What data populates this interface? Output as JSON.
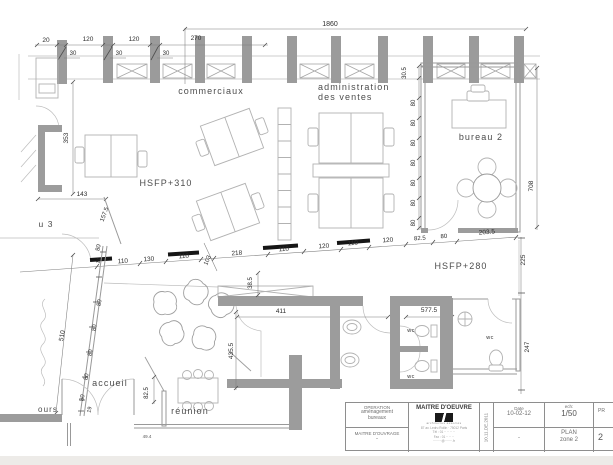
{
  "colors": {
    "wall_gray": "#9c9c9c",
    "line_gray": "#9a9a9a",
    "furniture_gray": "#b2b2b2",
    "beam_black": "#161616",
    "dim_text": "#2d2d2d",
    "paper": "#ffffff",
    "footer_strip": "#edebe8"
  },
  "title_block": {
    "operation_label": "OPERATION",
    "operation_l1": "aménagement",
    "operation_l2": "bureaux",
    "ouvrage_label": "MAITRE  D'OUVRAGE",
    "ouvrage_value": "-",
    "oeuvre_label": "MAITRE D'OEUVRE",
    "oeuvre_caption": "architectes associés",
    "addr1": "87 av. Ledru Rollin · 75012 Paris",
    "addr2": "Tél : 01 ·· ·· ·· ··",
    "addr3": "Fax : 01 ·· ·· ··",
    "addr4": "········@·······.fr",
    "stamp": "10.11.DE.2011",
    "date_label": "Date",
    "date_value": "10-02-12",
    "date_below": "-",
    "scale_label": "ech:",
    "scale_value": "1/50",
    "plan_l1": "PLAN",
    "plan_l2": "zone 2",
    "doc_top": "PR",
    "doc_bottom": "2"
  },
  "annotations": [
    {
      "t": "1860",
      "x": 330,
      "y": 26,
      "s": 7,
      "n": "dim-1860"
    },
    {
      "t": "20",
      "x": 46,
      "y": 42,
      "n": "dim-20"
    },
    {
      "t": "120",
      "x": 88,
      "y": 41,
      "n": "dim-120-a"
    },
    {
      "t": "120",
      "x": 134,
      "y": 41,
      "n": "dim-120-b"
    },
    {
      "t": "270",
      "x": 196,
      "y": 40,
      "n": "dim-270"
    },
    {
      "t": "30",
      "x": 73,
      "y": 55,
      "s": 6,
      "n": "dim-30-a"
    },
    {
      "t": "30",
      "x": 119,
      "y": 55,
      "s": 6,
      "n": "dim-30-b"
    },
    {
      "t": "30",
      "x": 166,
      "y": 55,
      "s": 6,
      "n": "dim-30-c"
    },
    {
      "t": "353",
      "x": 68,
      "y": 138,
      "r": -90,
      "n": "dim-353"
    },
    {
      "t": "143",
      "x": 82,
      "y": 196,
      "n": "dim-143"
    },
    {
      "t": "157.5",
      "x": 106,
      "y": 215,
      "r": -70,
      "s": 6,
      "n": "dim-157-5"
    },
    {
      "t": "80",
      "x": 100,
      "y": 248,
      "r": -78,
      "s": 6,
      "n": "dim-80-wall-top"
    },
    {
      "t": "17",
      "x": 100,
      "y": 261,
      "r": -78,
      "s": 5,
      "n": "dim-17"
    },
    {
      "t": "110",
      "x": 123,
      "y": 263,
      "r": -4,
      "n": "dim-110-a"
    },
    {
      "t": "130",
      "x": 149,
      "y": 261,
      "r": -4,
      "n": "dim-130"
    },
    {
      "t": "110",
      "x": 184,
      "y": 258,
      "r": -4,
      "n": "dim-110-b"
    },
    {
      "t": "103",
      "x": 209,
      "y": 261,
      "r": -66,
      "s": 6,
      "n": "dim-103"
    },
    {
      "t": "218",
      "x": 237,
      "y": 255,
      "r": -4,
      "n": "dim-218"
    },
    {
      "t": "110",
      "x": 284,
      "y": 251,
      "r": -4,
      "n": "dim-110-c"
    },
    {
      "t": "120",
      "x": 324,
      "y": 248,
      "r": -4,
      "n": "dim-120-c"
    },
    {
      "t": "110",
      "x": 353,
      "y": 245,
      "r": -4,
      "n": "dim-110-d"
    },
    {
      "t": "120",
      "x": 388,
      "y": 242,
      "r": -4,
      "n": "dim-120-d"
    },
    {
      "t": "82.5",
      "x": 420,
      "y": 240,
      "r": -4,
      "s": 6,
      "n": "dim-82-5-a"
    },
    {
      "t": "80",
      "x": 444,
      "y": 238,
      "r": -4,
      "s": 6,
      "n": "dim-80-a"
    },
    {
      "t": "203.5",
      "x": 487,
      "y": 234,
      "r": -4,
      "n": "dim-203-5"
    },
    {
      "t": "30.5",
      "x": 406,
      "y": 73,
      "r": -90,
      "s": 6,
      "n": "dim-30-5"
    },
    {
      "t": "80",
      "x": 415,
      "y": 103,
      "r": -90,
      "s": 6,
      "n": "dim-80-b1"
    },
    {
      "t": "80",
      "x": 415,
      "y": 123,
      "r": -90,
      "s": 6,
      "n": "dim-80-b2"
    },
    {
      "t": "80",
      "x": 415,
      "y": 143,
      "r": -90,
      "s": 6,
      "n": "dim-80-b3"
    },
    {
      "t": "80",
      "x": 415,
      "y": 163,
      "r": -90,
      "s": 6,
      "n": "dim-80-b4"
    },
    {
      "t": "80",
      "x": 415,
      "y": 183,
      "r": -90,
      "s": 6,
      "n": "dim-80-b5"
    },
    {
      "t": "80",
      "x": 415,
      "y": 203,
      "r": -90,
      "s": 6,
      "n": "dim-80-b6"
    },
    {
      "t": "80",
      "x": 415,
      "y": 223,
      "r": -90,
      "s": 6,
      "n": "dim-80-b7"
    },
    {
      "t": "708",
      "x": 533,
      "y": 186,
      "r": -90,
      "n": "dim-708"
    },
    {
      "t": "225",
      "x": 525,
      "y": 260,
      "r": -90,
      "n": "dim-225"
    },
    {
      "t": "247",
      "x": 529,
      "y": 347,
      "r": -90,
      "n": "dim-247"
    },
    {
      "t": "38.5",
      "x": 252,
      "y": 283,
      "r": -90,
      "s": 6,
      "n": "dim-38-5"
    },
    {
      "t": "411",
      "x": 281,
      "y": 313,
      "n": "dim-411"
    },
    {
      "t": "435.5",
      "x": 233,
      "y": 351,
      "r": -90,
      "n": "dim-435-5"
    },
    {
      "t": "577.5",
      "x": 429,
      "y": 312,
      "s": 6.5,
      "n": "dim-577-5"
    },
    {
      "t": "510",
      "x": 64,
      "y": 336,
      "r": -80,
      "n": "dim-510"
    },
    {
      "t": "80",
      "x": 101,
      "y": 303,
      "r": -80,
      "s": 6,
      "n": "dim-80-w1"
    },
    {
      "t": "80",
      "x": 96,
      "y": 328,
      "r": -80,
      "s": 6,
      "n": "dim-80-w2"
    },
    {
      "t": "80",
      "x": 92,
      "y": 353,
      "r": -80,
      "s": 6,
      "n": "dim-80-w3"
    },
    {
      "t": "80",
      "x": 88,
      "y": 377,
      "r": -80,
      "s": 6,
      "n": "dim-80-w4"
    },
    {
      "t": "80",
      "x": 84,
      "y": 398,
      "r": -80,
      "s": 6,
      "n": "dim-80-w5"
    },
    {
      "t": "19",
      "x": 91,
      "y": 410,
      "r": -78,
      "s": 5.5,
      "n": "dim-19"
    },
    {
      "t": "82.5",
      "x": 148,
      "y": 393,
      "r": -90,
      "s": 6,
      "n": "dim-82-5-reunion"
    },
    {
      "t": "49.4",
      "x": 147,
      "y": 438,
      "c": "tiny",
      "n": "dim-49-4"
    },
    {
      "t": "commerciaux",
      "x": 211,
      "y": 94,
      "c": "room",
      "n": "room-label-commerciaux"
    },
    {
      "t": "administration",
      "x": 318,
      "y": 90,
      "c": "room",
      "anchor": "start",
      "n": "room-label-administration"
    },
    {
      "t": "des ventes",
      "x": 318,
      "y": 100,
      "c": "room",
      "anchor": "start",
      "n": "room-label-des-ventes"
    },
    {
      "t": "bureau 2",
      "x": 481,
      "y": 140,
      "c": "room",
      "n": "room-label-bureau-2"
    },
    {
      "t": "HSFP+310",
      "x": 166,
      "y": 186,
      "c": "room",
      "n": "level-label-hsfp-310"
    },
    {
      "t": "HSFP+280",
      "x": 461,
      "y": 269,
      "c": "room",
      "n": "level-label-hsfp-280"
    },
    {
      "t": "accueil",
      "x": 110,
      "y": 386,
      "c": "room",
      "n": "room-label-accueil"
    },
    {
      "t": "réunion",
      "x": 190,
      "y": 414,
      "c": "room",
      "n": "room-label-reunion"
    },
    {
      "t": "u 3",
      "x": 46,
      "y": 227,
      "c": "room",
      "s": 8.5,
      "n": "room-label-bureau-3-partial"
    },
    {
      "t": "ours",
      "x": 48,
      "y": 412,
      "c": "room",
      "s": 8,
      "n": "room-label-ours-partial"
    },
    {
      "t": "wc",
      "x": 411,
      "y": 332,
      "c": "room-sm",
      "n": "room-label-wc-1"
    },
    {
      "t": "wc",
      "x": 411,
      "y": 378,
      "c": "room-sm",
      "n": "room-label-wc-2"
    },
    {
      "t": "wc",
      "x": 490,
      "y": 339,
      "c": "room-sm",
      "n": "room-label-wc-3"
    }
  ]
}
